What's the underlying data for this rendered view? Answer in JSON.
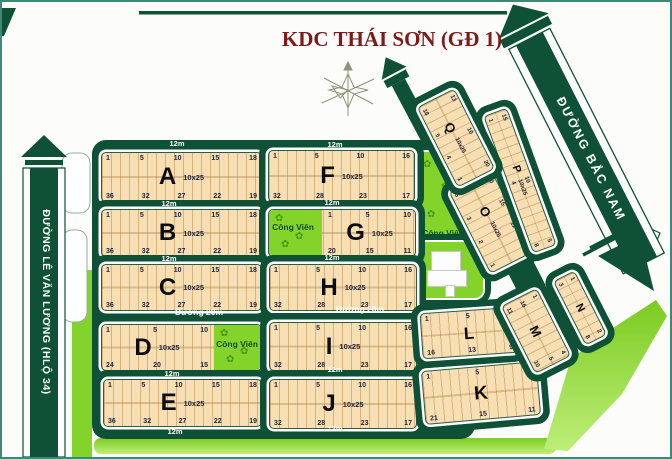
{
  "title": "KDC THÁI SƠN (GĐ 1)",
  "roads": {
    "left_road": "ĐƯỜNG LÊ VĂN LƯƠNG (HLỘ 34)",
    "right_road": "ĐƯỜNG BẮC NAM",
    "label_12m": "12m",
    "label_20m": "Đường 20m"
  },
  "park_label": "Công Viên",
  "colors": {
    "road_green": "#0E5137",
    "lot_tan": "#F7DFB3",
    "park_lime": "#84D32B",
    "title_red": "#7E1A1A"
  },
  "blocks": [
    {
      "id": "A",
      "letter": "A",
      "dim": "10x25",
      "top": [
        "1",
        "5",
        "10",
        "15",
        "18"
      ],
      "bottom": [
        "36",
        "32",
        "27",
        "22",
        "19"
      ]
    },
    {
      "id": "B",
      "letter": "B",
      "dim": "10x25",
      "top": [
        "1",
        "5",
        "10",
        "15",
        "18"
      ],
      "bottom": [
        "36",
        "32",
        "27",
        "22",
        "19"
      ]
    },
    {
      "id": "C",
      "letter": "C",
      "dim": "10x25",
      "top": [
        "1",
        "5",
        "10",
        "15",
        "18"
      ],
      "bottom": [
        "36",
        "32",
        "27",
        "22",
        "19"
      ]
    },
    {
      "id": "D",
      "letter": "D",
      "dim": "10x25",
      "top": [
        "1",
        "5",
        "10"
      ],
      "bottom": [
        "24",
        "20",
        "15"
      ],
      "park": "Công Viên"
    },
    {
      "id": "E",
      "letter": "E",
      "dim": "10x25",
      "top": [
        "1",
        "5",
        "10",
        "15",
        "18"
      ],
      "bottom": [
        "36",
        "32",
        "27",
        "22",
        "19"
      ]
    },
    {
      "id": "F",
      "letter": "F",
      "dim": "10x25",
      "top": [
        "1",
        "5",
        "10",
        "16"
      ],
      "bottom": [
        "32",
        "28",
        "23",
        "17"
      ]
    },
    {
      "id": "G",
      "letter": "G",
      "dim": "10x25",
      "top": [
        "1",
        "5",
        "10"
      ],
      "bottom": [
        "20",
        "15",
        "11"
      ],
      "park": "Công Viên"
    },
    {
      "id": "H",
      "letter": "H",
      "dim": "10x25",
      "top": [
        "1",
        "5",
        "10",
        "16"
      ],
      "bottom": [
        "32",
        "28",
        "23",
        "17"
      ]
    },
    {
      "id": "I",
      "letter": "I",
      "dim": "10x25",
      "top": [
        "1",
        "5",
        "10",
        "16"
      ],
      "bottom": [
        "32",
        "28",
        "23",
        "17"
      ]
    },
    {
      "id": "J",
      "letter": "J",
      "dim": "10x25",
      "top": [
        "1",
        "5",
        "10",
        "16"
      ],
      "bottom": [
        "32",
        "28",
        "23",
        "17"
      ]
    },
    {
      "id": "K",
      "letter": "K",
      "dim": "",
      "top": [
        "1",
        "5",
        "10"
      ],
      "bottom": [
        "21",
        "15",
        "11"
      ]
    },
    {
      "id": "L",
      "letter": "L",
      "dim": "",
      "top": [
        "1",
        "5",
        "8"
      ],
      "bottom": [
        "16",
        "13",
        "9"
      ]
    },
    {
      "id": "M",
      "letter": "M",
      "dim": "",
      "top": [
        "1",
        "4"
      ],
      "mid": [
        "16",
        "5"
      ],
      "bottom": [
        "11",
        "10"
      ]
    },
    {
      "id": "N",
      "letter": "N",
      "dim": "",
      "top": [
        "1",
        "2"
      ],
      "bottom": [
        "3",
        "8"
      ]
    },
    {
      "id": "O",
      "letter": "O",
      "dim": "10x25",
      "top": [
        "20",
        "15",
        "11",
        "14"
      ],
      "bottom": [
        "5",
        "3",
        "2",
        "1"
      ]
    },
    {
      "id": "P",
      "letter": "P",
      "dim": "10x25",
      "top": [
        "15",
        "10",
        "5"
      ],
      "bottom": [
        "1",
        "4",
        "8"
      ]
    },
    {
      "id": "Q",
      "letter": "Q",
      "dim": "10x25",
      "top": [
        "13",
        "10",
        "20"
      ],
      "bottom": [
        "18",
        "5",
        "4",
        "1"
      ]
    }
  ]
}
